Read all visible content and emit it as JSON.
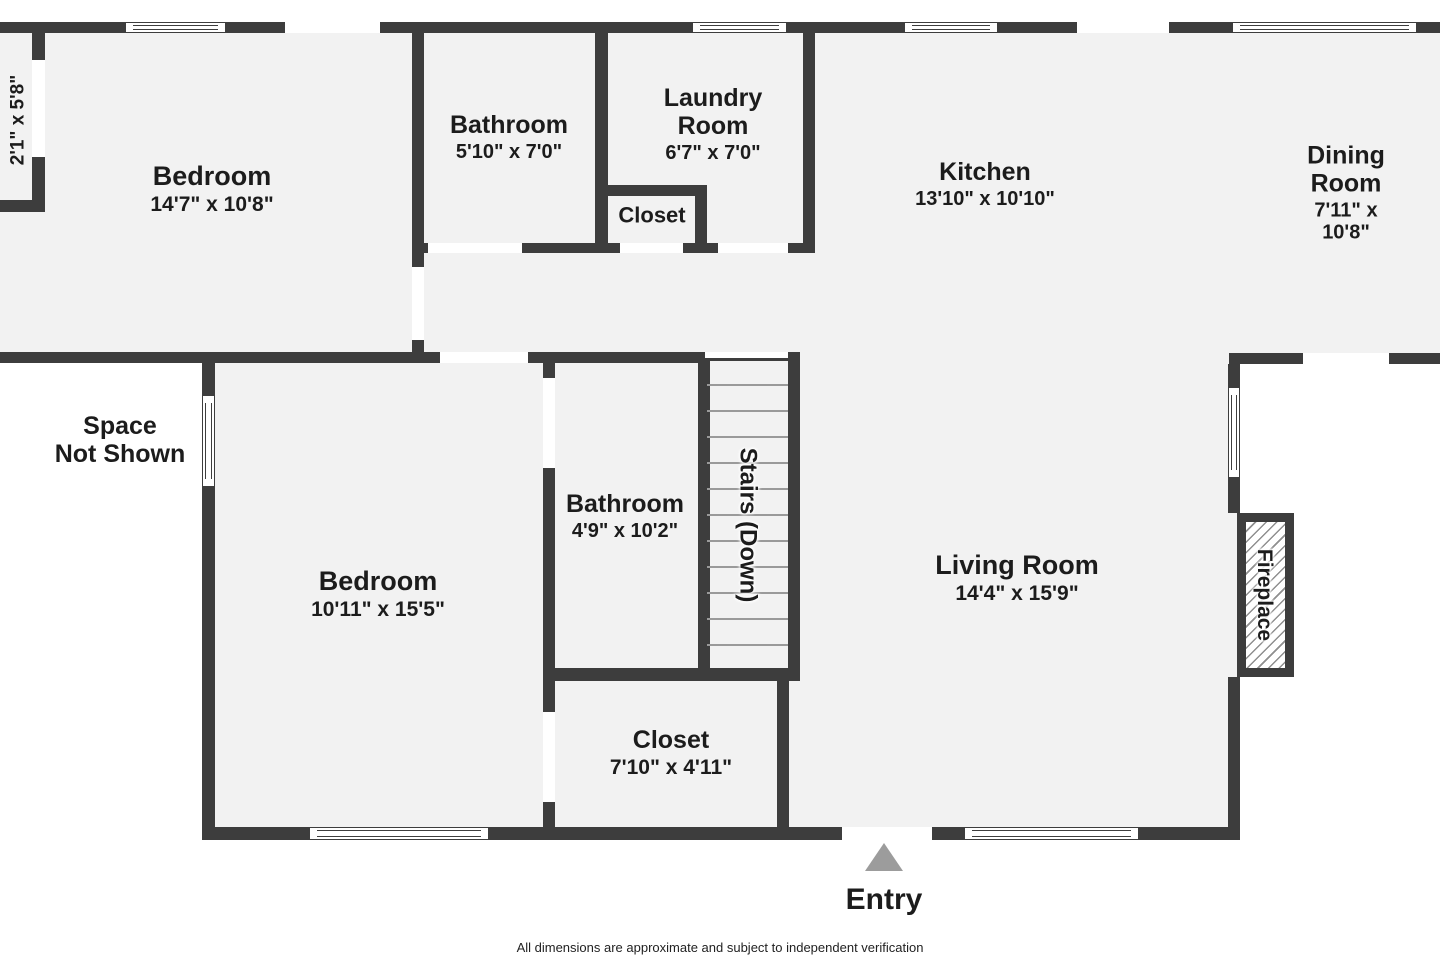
{
  "colors": {
    "wall": "#3d3d3d",
    "floor": "#f2f2f2",
    "outside": "#ffffff",
    "text": "#1c1c1c",
    "entry_triangle": "#9c9c9c",
    "stair_tread": "#9a9a9a"
  },
  "footer": {
    "text": "All dimensions are approximate and subject to independent verification"
  },
  "entry": {
    "label": "Entry",
    "triangle": {
      "x": 865,
      "y": 843
    },
    "label_pos": {
      "cx": 884,
      "cy": 900
    }
  },
  "rooms": [
    {
      "id": "bedroom-upper",
      "name": "Bedroom",
      "dims": "14'7\" x 10'8\"",
      "cx": 212,
      "cy": 189,
      "ns": 27,
      "ds": 21
    },
    {
      "id": "bathroom-upper",
      "name": "Bathroom",
      "dims": "5'10\" x 7'0\"",
      "cx": 509,
      "cy": 137,
      "ns": 25,
      "ds": 20
    },
    {
      "id": "laundry-room",
      "name": "Laundry\nRoom",
      "dims": "6'7\" x 7'0\"",
      "cx": 713,
      "cy": 124,
      "ns": 25,
      "ds": 20
    },
    {
      "id": "closet-upper",
      "name": "Closet",
      "cx": 652,
      "cy": 216,
      "ns": 22
    },
    {
      "id": "kitchen",
      "name": "Kitchen",
      "dims": "13'10\" x 10'10\"",
      "cx": 985,
      "cy": 184,
      "ns": 25,
      "ds": 20
    },
    {
      "id": "dining-room",
      "name": "Dining Room",
      "dims": "7'11\" x 10'8\"",
      "cx": 1346,
      "cy": 193,
      "ns": 25,
      "ds": 20
    },
    {
      "id": "bumpout-dims",
      "name": "2'1\" x 5'8\"",
      "cx": 18,
      "cy": 120,
      "ns": 19,
      "rot": -90
    },
    {
      "id": "space-not-shown",
      "name": "Space\nNot Shown",
      "cx": 120,
      "cy": 440,
      "ns": 25
    },
    {
      "id": "bedroom-lower",
      "name": "Bedroom",
      "dims": "10'11\" x 15'5\"",
      "cx": 378,
      "cy": 594,
      "ns": 27,
      "ds": 21
    },
    {
      "id": "bathroom-lower",
      "name": "Bathroom",
      "dims": "4'9\" x 10'2\"",
      "cx": 625,
      "cy": 516,
      "ns": 25,
      "ds": 20
    },
    {
      "id": "stairs",
      "name": "Stairs (Down)",
      "cx": 747,
      "cy": 525,
      "ns": 24,
      "rot": 90,
      "halo": true
    },
    {
      "id": "living-room",
      "name": "Living Room",
      "dims": "14'4\" x 15'9\"",
      "cx": 1017,
      "cy": 578,
      "ns": 27,
      "ds": 21
    },
    {
      "id": "closet-lower",
      "name": "Closet",
      "dims": "7'10\" x 4'11\"",
      "cx": 671,
      "cy": 753,
      "ns": 25,
      "ds": 21
    },
    {
      "id": "fireplace",
      "name": "Fireplace",
      "cx": 1264,
      "cy": 595,
      "ns": 21,
      "rot": 90,
      "halo": true
    }
  ],
  "geometry": {
    "floors": [
      [
        0,
        33,
        1440,
        320
      ],
      [
        202,
        353,
        341,
        487
      ],
      [
        543,
        353,
        697,
        487
      ]
    ],
    "walls": [
      [
        0,
        22,
        126,
        11
      ],
      [
        225,
        22,
        60,
        11
      ],
      [
        380,
        22,
        313,
        11
      ],
      [
        786,
        22,
        119,
        11
      ],
      [
        997,
        22,
        80,
        11
      ],
      [
        1169,
        22,
        64,
        11
      ],
      [
        1416,
        22,
        24,
        11
      ],
      [
        0,
        200,
        45,
        12
      ],
      [
        32,
        33,
        13,
        27
      ],
      [
        32,
        157,
        13,
        43
      ],
      [
        412,
        33,
        12,
        234
      ],
      [
        412,
        340,
        12,
        23
      ],
      [
        595,
        33,
        13,
        220
      ],
      [
        803,
        33,
        12,
        220
      ],
      [
        607,
        185,
        100,
        11
      ],
      [
        695,
        196,
        12,
        47
      ],
      [
        412,
        243,
        16,
        10
      ],
      [
        522,
        243,
        98,
        10
      ],
      [
        683,
        243,
        35,
        10
      ],
      [
        788,
        243,
        27,
        10
      ],
      [
        0,
        352,
        440,
        11
      ],
      [
        528,
        352,
        177,
        11
      ],
      [
        1229,
        353,
        74,
        11
      ],
      [
        1389,
        353,
        51,
        11
      ],
      [
        202,
        363,
        13,
        33
      ],
      [
        202,
        486,
        13,
        354
      ],
      [
        543,
        363,
        12,
        15
      ],
      [
        543,
        468,
        12,
        244
      ],
      [
        543,
        802,
        12,
        38
      ],
      [
        698,
        358,
        12,
        310
      ],
      [
        788,
        352,
        12,
        329
      ],
      [
        543,
        668,
        257,
        13
      ],
      [
        777,
        681,
        12,
        159
      ],
      [
        1228,
        364,
        12,
        24
      ],
      [
        1228,
        477,
        12,
        36
      ],
      [
        1228,
        677,
        12,
        163
      ],
      [
        202,
        827,
        108,
        13
      ],
      [
        488,
        827,
        354,
        13
      ],
      [
        932,
        827,
        33,
        13
      ],
      [
        1138,
        827,
        102,
        13
      ]
    ],
    "gaps": [
      [
        285,
        22,
        95,
        11
      ],
      [
        1077,
        22,
        92,
        11
      ],
      [
        428,
        243,
        94,
        10
      ],
      [
        620,
        243,
        63,
        10
      ],
      [
        718,
        243,
        70,
        10
      ],
      [
        412,
        267,
        12,
        73
      ],
      [
        440,
        352,
        88,
        11
      ],
      [
        1303,
        353,
        86,
        11
      ],
      [
        543,
        378,
        12,
        90
      ],
      [
        543,
        712,
        12,
        90
      ],
      [
        842,
        827,
        90,
        13
      ],
      [
        32,
        60,
        13,
        97
      ],
      [
        705,
        352,
        83,
        6
      ]
    ],
    "windows_h": [
      [
        126,
        22,
        99,
        11
      ],
      [
        693,
        22,
        93,
        11
      ],
      [
        905,
        22,
        92,
        11
      ],
      [
        1233,
        22,
        183,
        11
      ],
      [
        310,
        827,
        178,
        13
      ],
      [
        965,
        827,
        173,
        13
      ]
    ],
    "windows_v": [
      [
        202,
        396,
        13,
        90
      ],
      [
        1228,
        388,
        12,
        89
      ]
    ],
    "stairs": {
      "topline": [
        705,
        358,
        83,
        3
      ],
      "tread_x": 707,
      "tread_w": 81,
      "tread_h": 2,
      "tread_ys": [
        384,
        410,
        436,
        462,
        488,
        514,
        540,
        566,
        592,
        618,
        644
      ]
    },
    "fireplace_box": {
      "x": 1237,
      "y": 513,
      "w": 57,
      "h": 164,
      "border": 9
    }
  }
}
